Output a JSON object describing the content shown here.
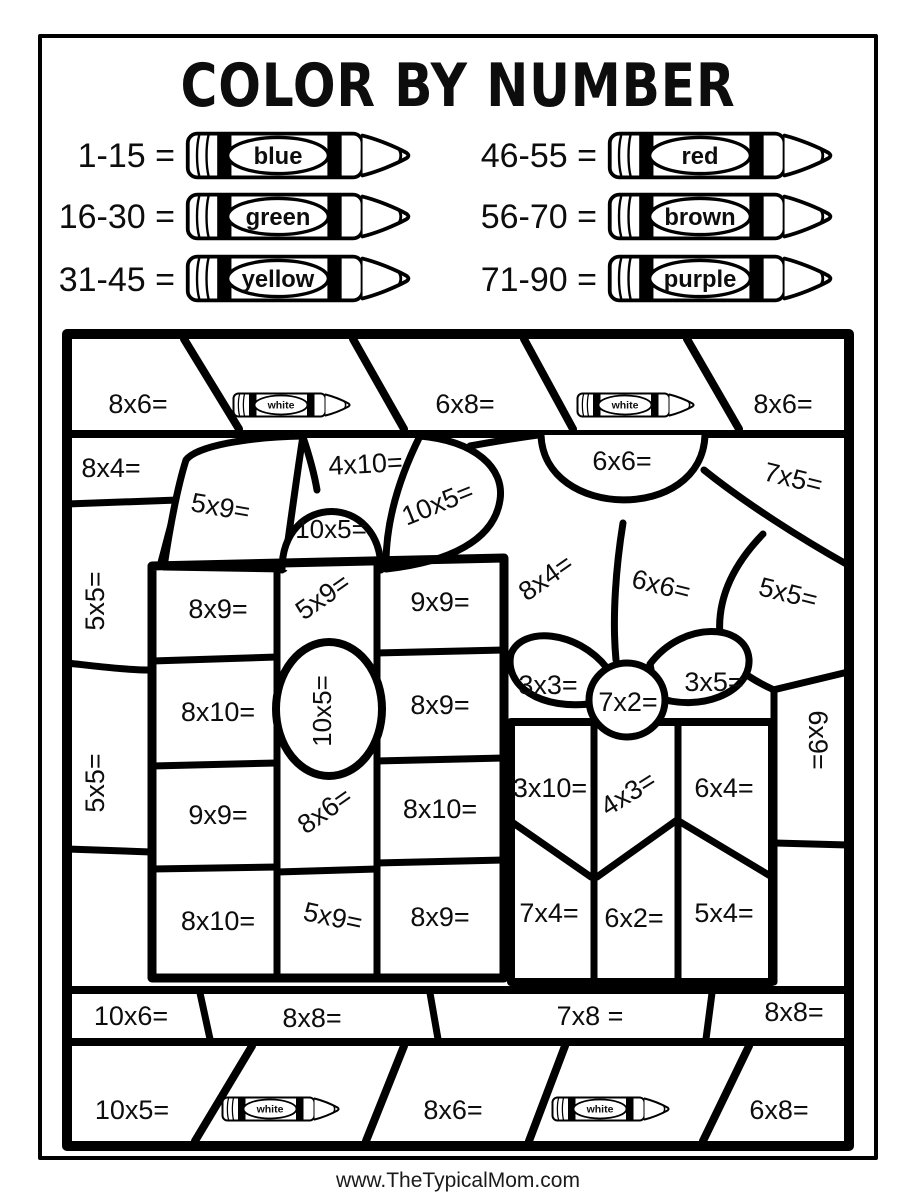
{
  "title": "COLOR BY NUMBER",
  "footer": "www.TheTypicalMom.com",
  "crayon_icon_label": "white",
  "colors": {
    "ink": "#000000",
    "paper": "#ffffff"
  },
  "legend": [
    {
      "range": "1-15 =",
      "color": "blue"
    },
    {
      "range": "16-30 =",
      "color": "green"
    },
    {
      "range": "31-45 =",
      "color": "yellow"
    },
    {
      "range": "46-55 =",
      "color": "red"
    },
    {
      "range": "56-70 =",
      "color": "brown"
    },
    {
      "range": "71-90 =",
      "color": "purple"
    }
  ],
  "puzzle": {
    "top_band": [
      "8x6=",
      "6x8=",
      "8x6="
    ],
    "upper": {
      "corner_left": "8x4=",
      "bow_backdrop": "4x10=",
      "bow_left_loop": "5x9=",
      "bow_knot_top": "10x5=",
      "bow_right_loop": "10x5=",
      "dome": "6x6=",
      "corner_right": "7x5="
    },
    "middle": {
      "diag_left": "8x4=",
      "diag_center": "6x6=",
      "diag_right": "5x5=",
      "left_edge_upper": "5x5=",
      "left_edge_lower": "5x5=",
      "right_edge": "6x9="
    },
    "gift_left": {
      "rows": [
        [
          "8x9=",
          "5x9=",
          "9x9="
        ],
        [
          "8x10=",
          "10x5=",
          "8x9="
        ],
        [
          "9x9=",
          "8x6=",
          "8x10="
        ],
        [
          "8x10=",
          "5x9=",
          "8x9="
        ]
      ]
    },
    "gift_right": {
      "bow": [
        "3x3=",
        "7x2=",
        "3x5="
      ],
      "rows": [
        [
          "3x10=",
          "4x3=",
          "6x4="
        ],
        [
          "7x4=",
          "6x2=",
          "5x4="
        ]
      ]
    },
    "strip": [
      "10x6=",
      "8x8=",
      "7x8 =",
      "8x8="
    ],
    "bottom_band": [
      "10x5=",
      "8x6=",
      "6x8="
    ]
  }
}
